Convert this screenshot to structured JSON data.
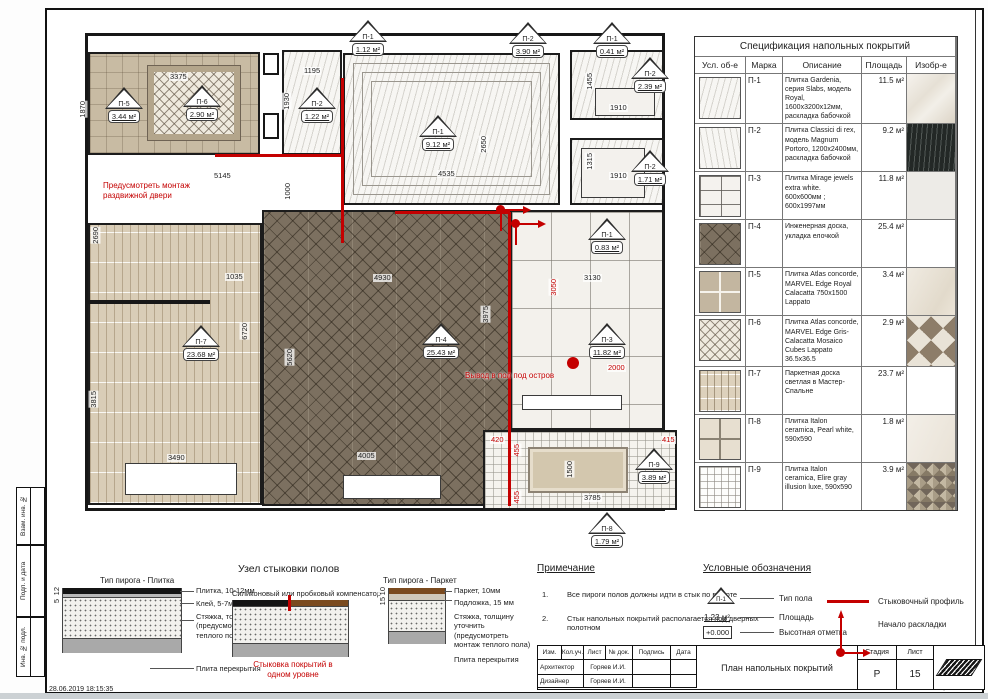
{
  "sheet": {
    "date_stamp": "28.06.2019  18:15:35",
    "format_label": "Формат А3",
    "side_labels": [
      "Взам. инв. №",
      "Подп. и дата",
      "Инв. № подл."
    ]
  },
  "spec_table": {
    "title": "Спецификация напольных покрытий",
    "headers": [
      "Усл. об-е",
      "Марка",
      "Описание",
      "Площадь",
      "Изобр-е"
    ],
    "rows": [
      {
        "mark": "П-1",
        "desc": "Плитка Gardenia, серия Slabs, модель Royal, 1600x3200x12мм, раскладка бабочкой",
        "area": "11.5 м²"
      },
      {
        "mark": "П-2",
        "desc": "Плитка Classici di rex, модель Magnum Portoro, 1200x2400мм, раскладка бабочкой",
        "area": "9.2 м²"
      },
      {
        "mark": "П-3",
        "desc": "Плитка Mirage jewels extra white. 600x600мм ; 600x1997мм",
        "area": "11.8 м²"
      },
      {
        "mark": "П-4",
        "desc": "Инженерная доска, укладка елочкой",
        "area": "25.4 м²"
      },
      {
        "mark": "П-5",
        "desc": "Плитка Atlas concorde, MARVEL Edge Royal Calacatta 750x1500 Lappato",
        "area": "3.4 м²"
      },
      {
        "mark": "П-6",
        "desc": "Плитка Atlas concorde, MARVEL Edge Gris-Calacatta Mosaico Cubes Lappato 36.5x36.5",
        "area": "2.9 м²"
      },
      {
        "mark": "П-7",
        "desc": "Паркетная доска светлая в Мастер-Спальне",
        "area": "23.7 м²"
      },
      {
        "mark": "П-8",
        "desc": "Плитка Italon ceramica, Pearl white, 590x590",
        "area": "1.8 м²"
      },
      {
        "mark": "П-9",
        "desc": "Плитка Italon ceramica, Elire gray illusion luxe, 590x590",
        "area": "3.9 м²"
      }
    ]
  },
  "plan": {
    "markers": [
      {
        "mark": "П-5",
        "area": "3.44 м²"
      },
      {
        "mark": "П-6",
        "area": "2.90 м²"
      },
      {
        "mark": "П-2",
        "area": "1.22 м²"
      },
      {
        "mark": "П-1",
        "area": "1.12 м²"
      },
      {
        "mark": "П-2",
        "area": "3.90 м²"
      },
      {
        "mark": "П-1",
        "area": "0.41 м²"
      },
      {
        "mark": "П-2",
        "area": "2.39 м²"
      },
      {
        "mark": "П-2",
        "area": "1.71 м²"
      },
      {
        "mark": "П-1",
        "area": "9.12 м²"
      },
      {
        "mark": "П-1",
        "area": "0.83 м²"
      },
      {
        "mark": "П-4",
        "area": "25.43 м²"
      },
      {
        "mark": "П-3",
        "area": "11.82 м²"
      },
      {
        "mark": "П-7",
        "area": "23.68 м²"
      },
      {
        "mark": "П-9",
        "area": "3.89 м²"
      },
      {
        "mark": "П-8",
        "area": "1.79 м²"
      }
    ],
    "dims": [
      "3375",
      "1870",
      "1195",
      "1930",
      "5145",
      "1000",
      "4535",
      "2650",
      "1455",
      "1910",
      "1315",
      "1910",
      "2690",
      "1035",
      "6720",
      "3815",
      "3490",
      "4930",
      "3975",
      "5620",
      "4005",
      "3130",
      "1500",
      "3785"
    ],
    "red_dims": [
      "3050",
      "2000",
      "420",
      "455",
      "455",
      "415"
    ],
    "notes": {
      "sliding_door": "Предусмотреть монтаж раздвижной двери",
      "island_outlet": "Вывод в пол под остров"
    }
  },
  "details": {
    "title": "Узел стыковки полов",
    "left": {
      "title": "Тип пирога - Плитка",
      "labels": [
        "Плитка, 10-12мм",
        "Клей, 5-7мм",
        "Стяжка, толщину уточнить (предусмотреть монтаж теплого пола)",
        "Плита перекрытия"
      ],
      "dims": [
        "12",
        "5"
      ]
    },
    "middle": {
      "title": "Силиконовый или пробковый компенсатор",
      "caption": "Стыковка покрытий в одном уровне"
    },
    "right": {
      "title": "Тип пирога - Паркет",
      "labels": [
        "Паркет, 10мм",
        "Подложка, 15 мм",
        "Стяжка, толщину уточнить (предусмотреть монтаж теплого пола)",
        "Плита перекрытия"
      ],
      "dims": [
        "10",
        "15"
      ]
    }
  },
  "notes": {
    "title": "Примечание",
    "items": [
      {
        "num": "1.",
        "text": "Все пироги полов должны идти в стык по высоте"
      },
      {
        "num": "2.",
        "text": "Стык напольных покрытий располагается под дверных полотном"
      }
    ]
  },
  "legend": {
    "title": "Условные обозначения",
    "type_mark": "П-1",
    "type_label": "Тип пола",
    "area_value": "1.23 м²",
    "area_label": "Площадь",
    "elev_value": "+0.000",
    "elev_label": "Высотная отметка",
    "profile_label": "Стыковочный профиль",
    "start_label": "Начало раскладки"
  },
  "title_block": {
    "headers": [
      "Изм.",
      "Кол.уч.",
      "Лист",
      "№ док.",
      "Подпись",
      "Дата"
    ],
    "row1_role": "Архитектор",
    "row1_name": "Горяев И.И.",
    "row2_role": "Дизайнер",
    "row2_name": "Горяев И.И.",
    "title": "План напольных покрытий",
    "stage_label": "Стадия",
    "stage_value": "Р",
    "sheet_label": "Лист",
    "sheet_value": "15"
  }
}
